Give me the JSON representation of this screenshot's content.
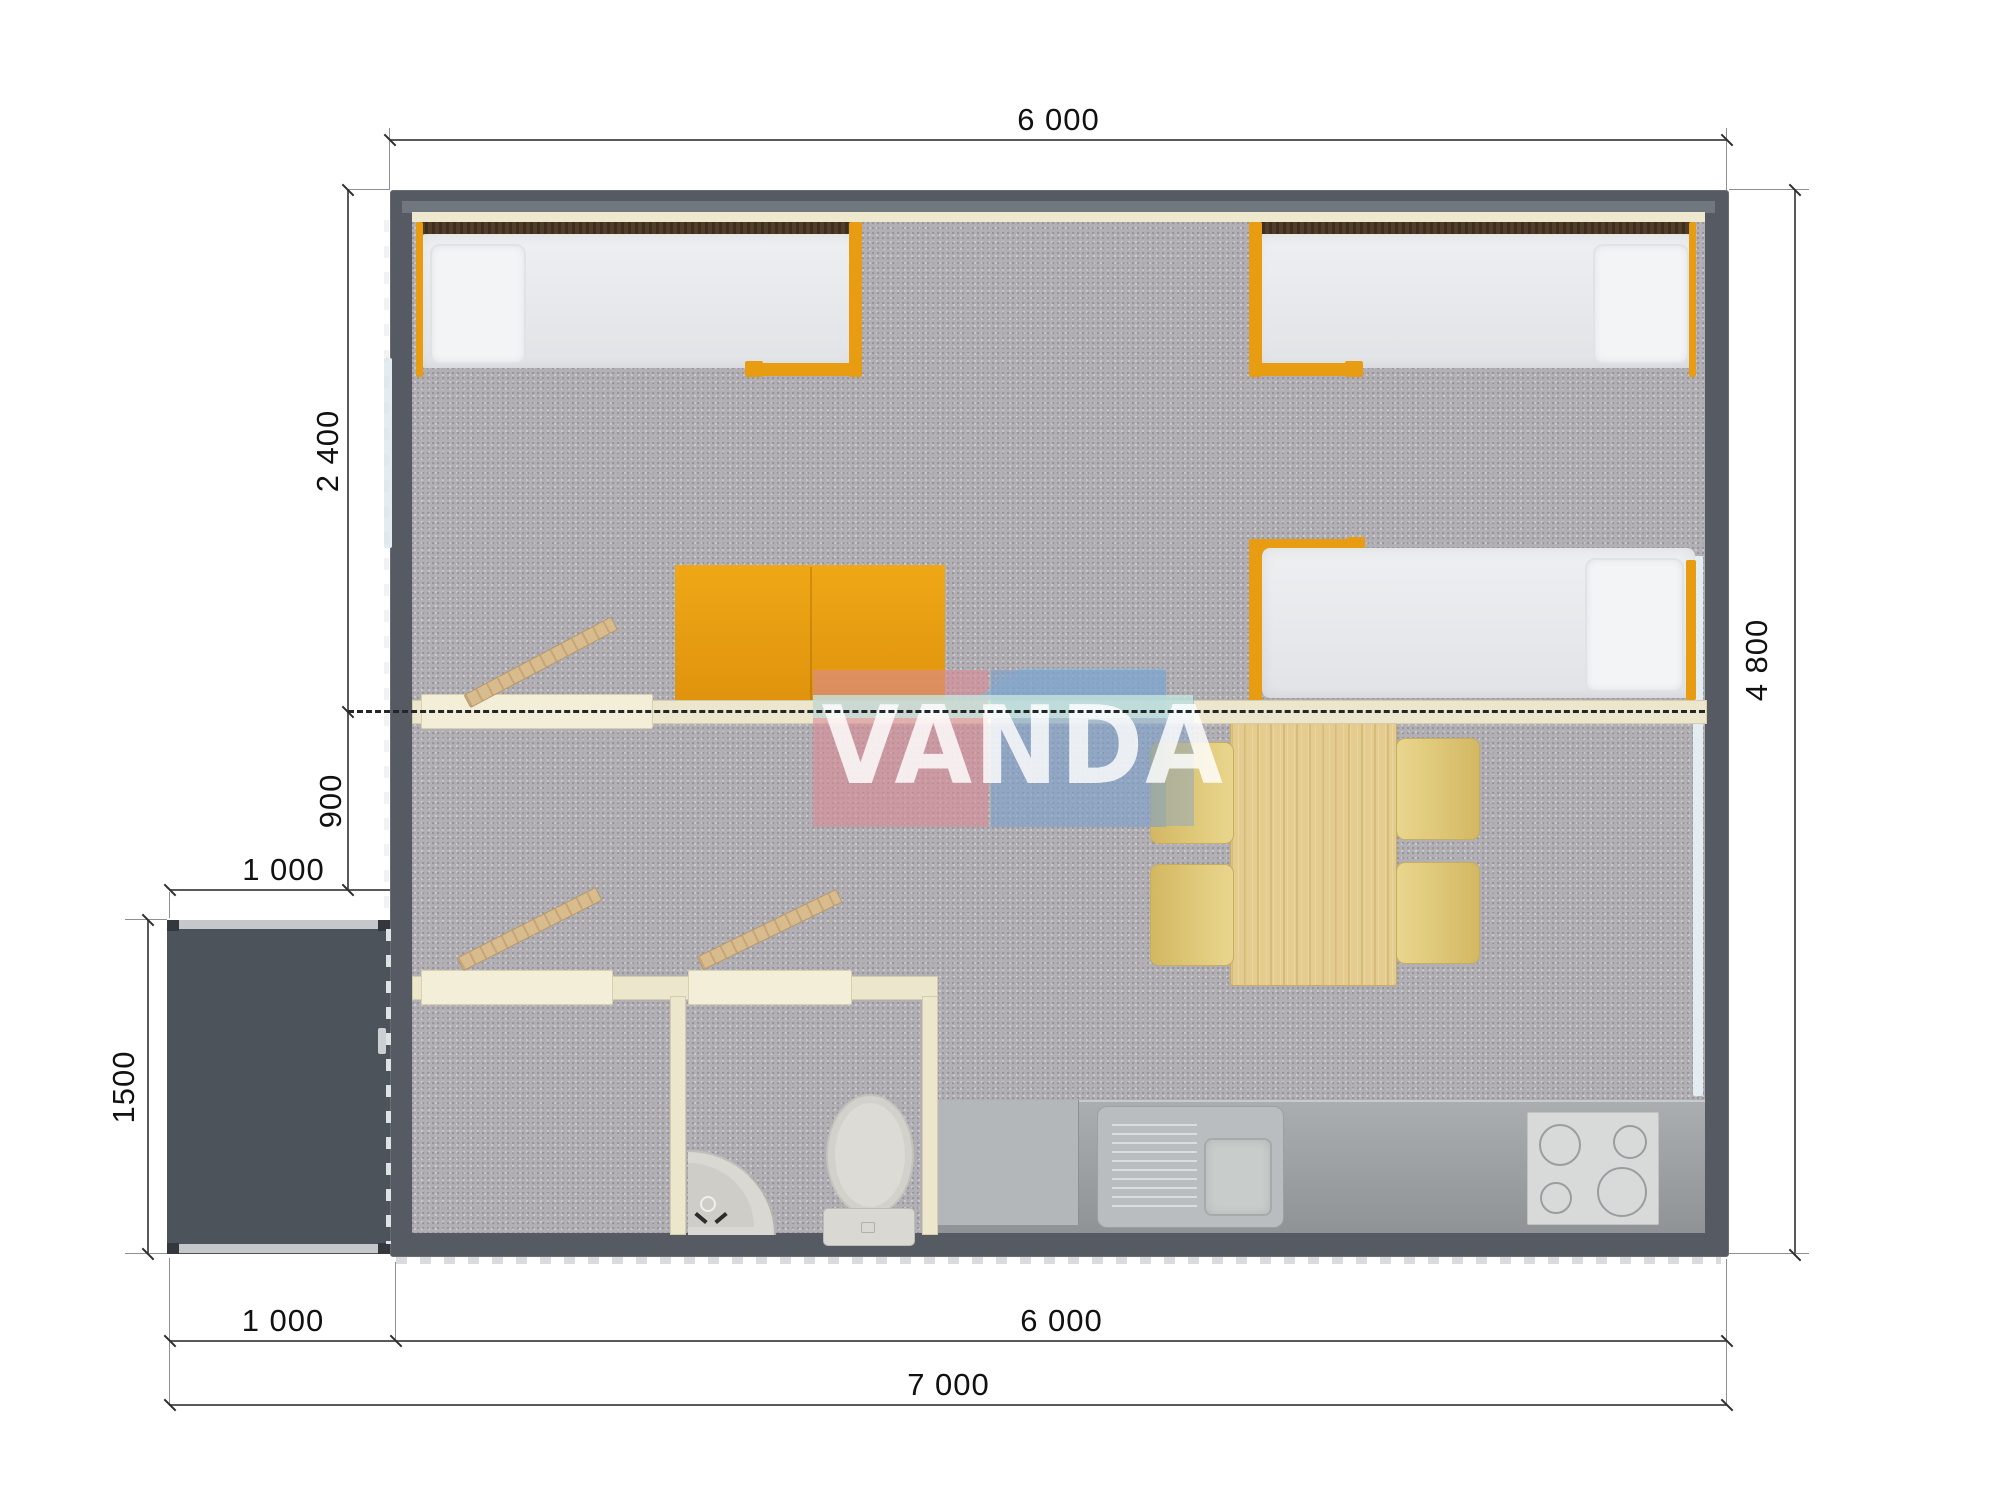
{
  "watermark": {
    "text": "VANDA",
    "pink": "#db8b96",
    "blue": "#7ca0cc",
    "teal": "#c4e5de"
  },
  "dimensions": {
    "top_width": "6 000",
    "right_height": "4 800",
    "bedroom_depth": "2 400",
    "hall_depth": "900",
    "porch_width_top": "1 000",
    "porch_depth": "1500",
    "bottom_porch_width": "1 000",
    "bottom_main_width": "6 000",
    "bottom_total_width": "7 000"
  },
  "palette": {
    "exterior_wall": "#565b63",
    "floor_carpet": "#b2b0b4",
    "interior_wall_wood": "#ece6cc",
    "furniture_accent_orange": "#e89c12",
    "mattress_white": "#e9ebed",
    "headboard_brown": "#523d29",
    "table_wood": "#e3cc8d",
    "chair_yellow": "#e2cc7d",
    "kitchen_counter_gray": "#a2a6a9",
    "fixture_white": "#d9d8d2",
    "porch_deck": "#4d535a",
    "dimension_line": "#5a5a5a"
  },
  "furniture": [
    "single-bed-top-left",
    "single-bed-top-right",
    "single-bed-mid-right",
    "orange-cabinet",
    "dining-table",
    "four-chairs",
    "corner-sink",
    "toilet",
    "kitchen-counter",
    "kitchen-sink-unit",
    "stove-four-burners",
    "entrance-porch"
  ]
}
